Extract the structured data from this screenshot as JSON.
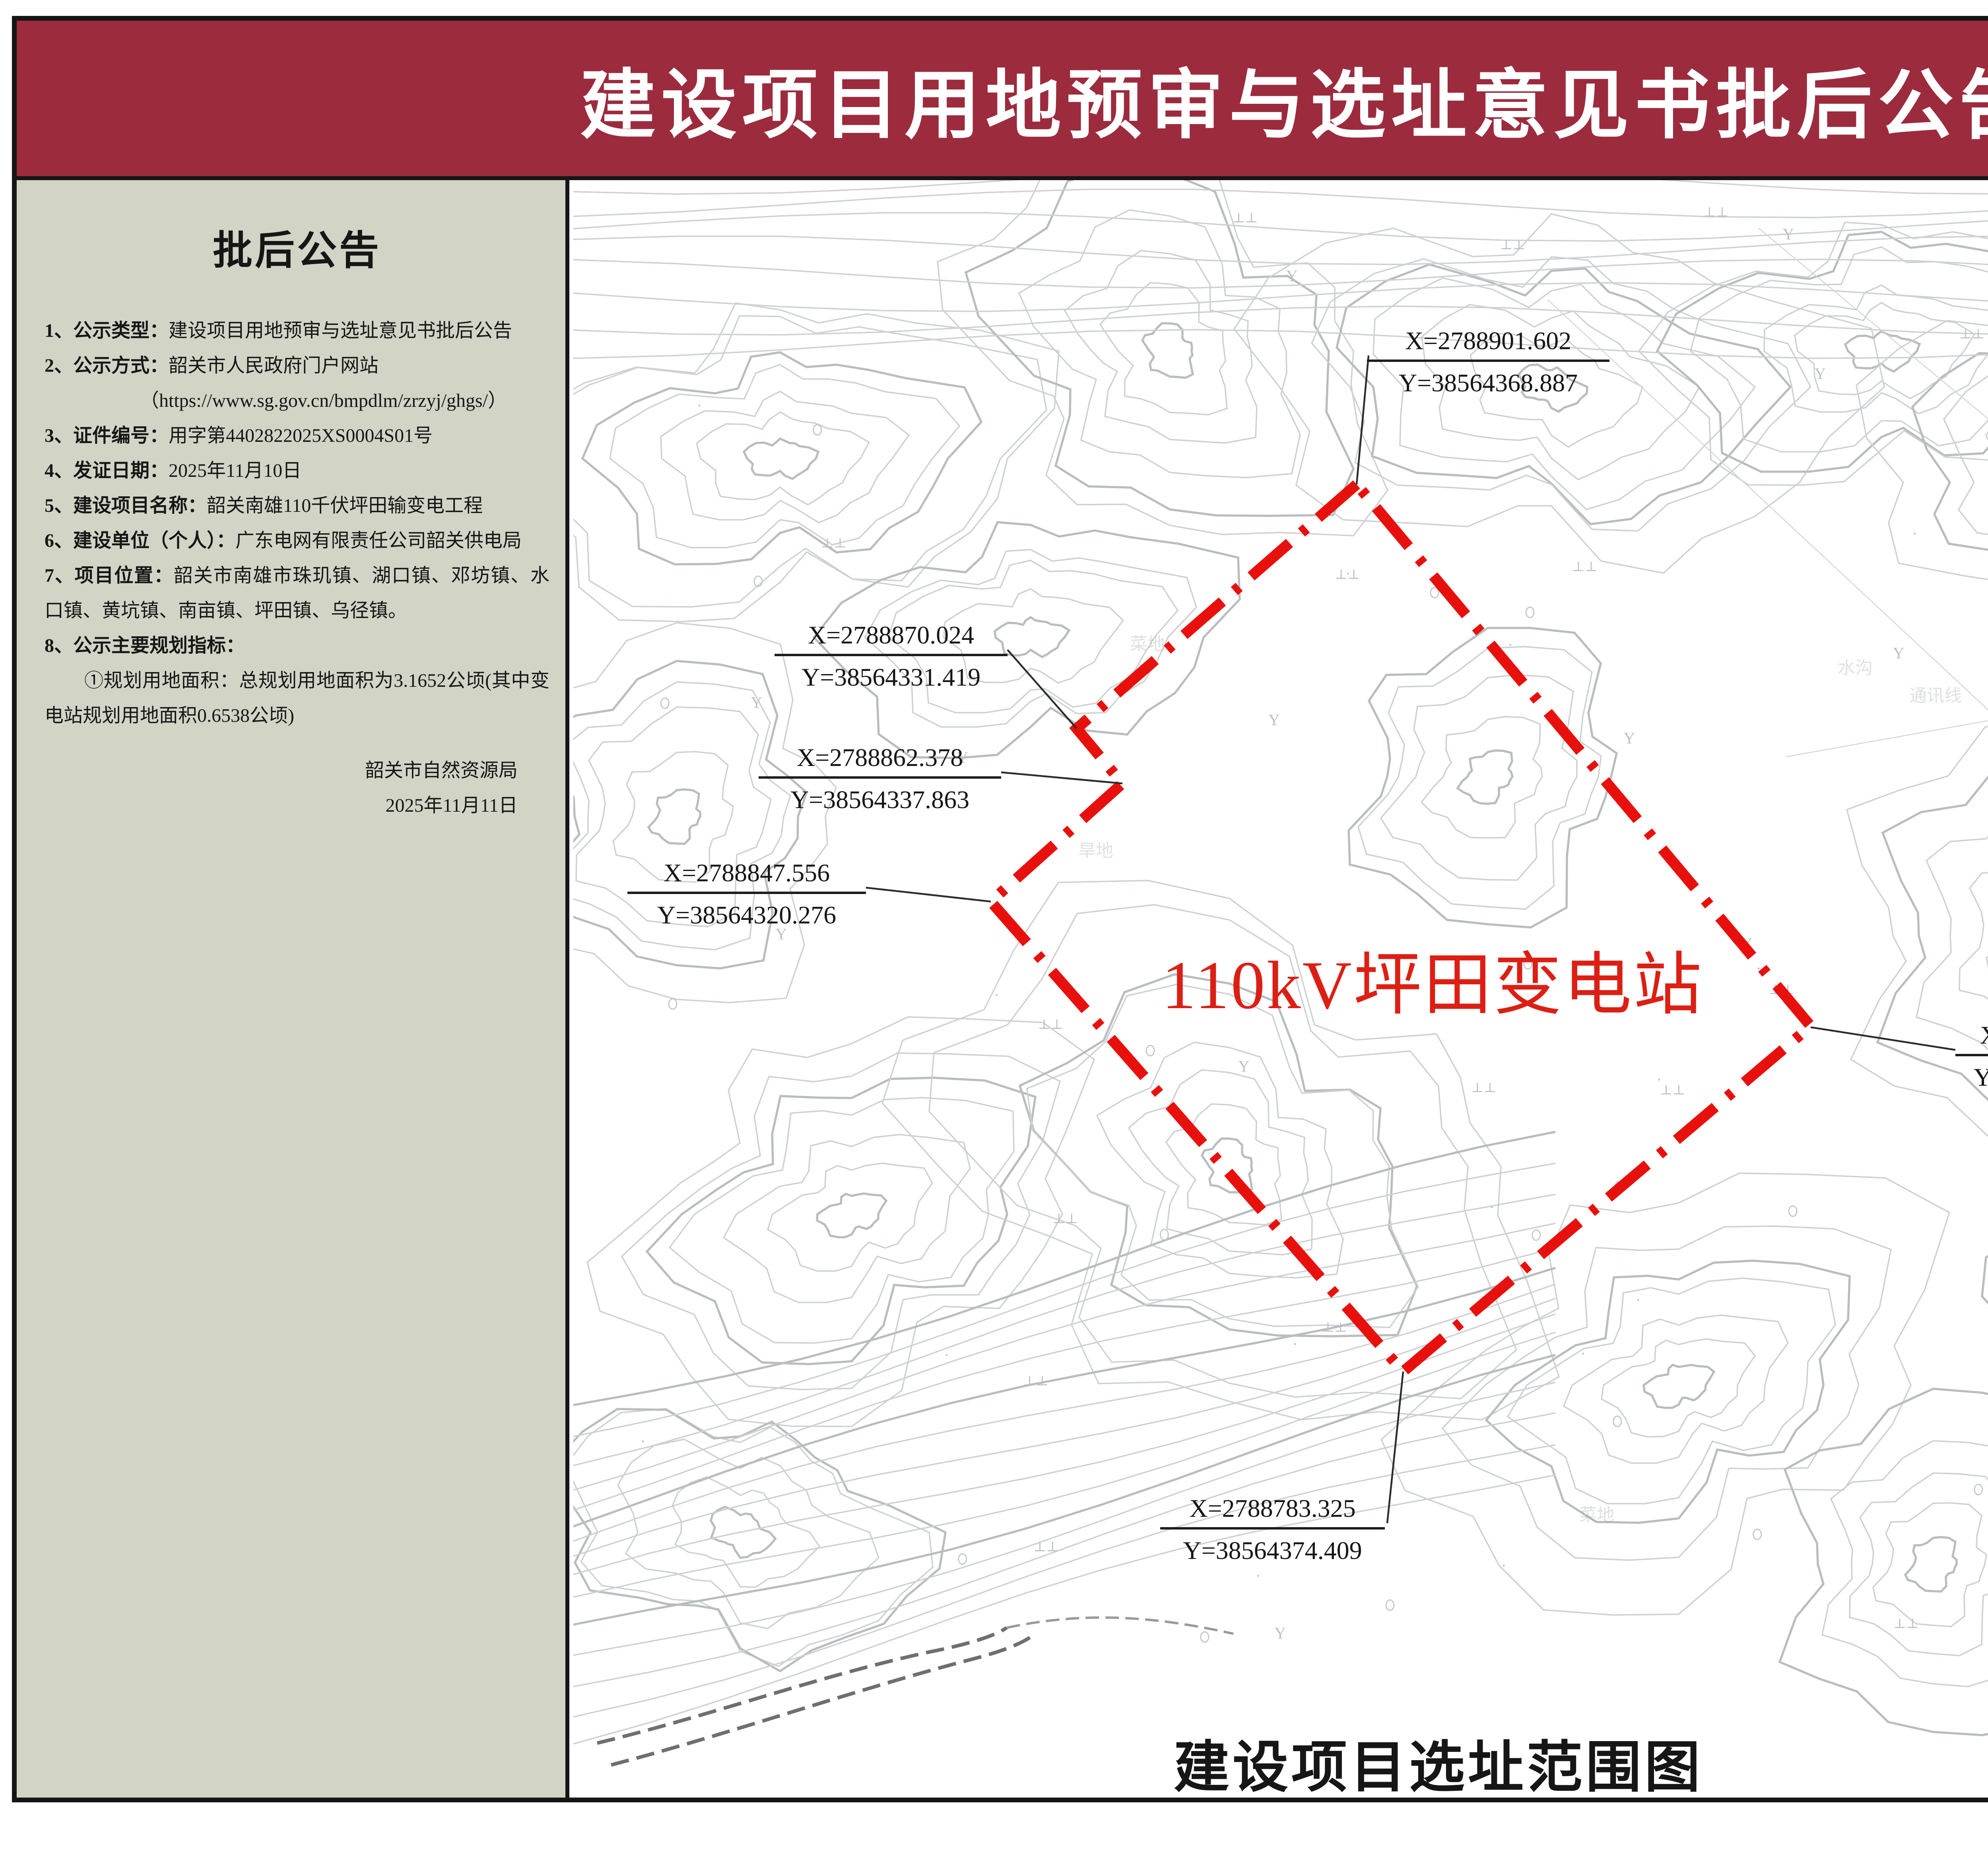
{
  "banner": {
    "title": "建设项目用地预审与选址意见书批后公告",
    "bg_color": "#9c2b3e"
  },
  "sidebar": {
    "bg_color": "#d2d4c6",
    "heading": "批后公告",
    "items": [
      {
        "label": "1、公示类型：",
        "text": "建设项目用地预审与选址意见书批后公告"
      },
      {
        "label": "2、公示方式：",
        "text": "韶关市人民政府门户网站"
      },
      {
        "label": "",
        "text": "（https://www.sg.gov.cn/bmpdlm/zrzyj/ghgs/）"
      },
      {
        "label": "3、证件编号：",
        "text": "用字第4402822025XS0004S01号"
      },
      {
        "label": "4、发证日期：",
        "text": "2025年11月10日"
      },
      {
        "label": "5、建设项目名称：",
        "text": "韶关南雄110千伏坪田输变电工程"
      },
      {
        "label": "6、建设单位（个人）：",
        "text": "广东电网有限责任公司韶关供电局"
      },
      {
        "label": "7、项目位置：",
        "text": "韶关市南雄市珠玑镇、湖口镇、邓坊镇、水口镇、黄坑镇、南亩镇、坪田镇、乌径镇。"
      },
      {
        "label": "8、公示主要规划指标：",
        "text": ""
      },
      {
        "label": "",
        "text": "①规划用地面积：总规划用地面积为3.1652公顷(其中变电站规划用地面积0.6538公顷)"
      }
    ],
    "signature_org": "韶关市自然资源局",
    "signature_date": "2025年11月11日"
  },
  "map": {
    "station_label": "110kV坪田变电站",
    "station_color": "#dc1f14",
    "redline_color": "#e8100c",
    "caption": "建设项目选址范围图",
    "coordinates": [
      {
        "x": "X=2788901.602",
        "y": "Y=38564368.887"
      },
      {
        "x": "X=2788870.024",
        "y": "Y=38564331.419"
      },
      {
        "x": "X=2788862.378",
        "y": "Y=38564337.863"
      },
      {
        "x": "X=2788847.556",
        "y": "Y=38564320.276"
      },
      {
        "x": "X=2788829.725",
        "y": "Y=38564429.465"
      },
      {
        "x": "X=2788783.325",
        "y": "Y=38564374.409"
      }
    ],
    "faint_labels": [
      "菜地",
      "旱地",
      "水沟",
      "通讯线",
      "油茶树",
      "菜地",
      "加茶村"
    ]
  },
  "right_panel": {
    "north_label": "N",
    "legend_title": "图    例",
    "legend_item_label": "规划建设用地红线",
    "location_title": "位置示意图",
    "location_place_label": "坪田镇",
    "producer": "监制单位：韶关市自然资源局"
  }
}
